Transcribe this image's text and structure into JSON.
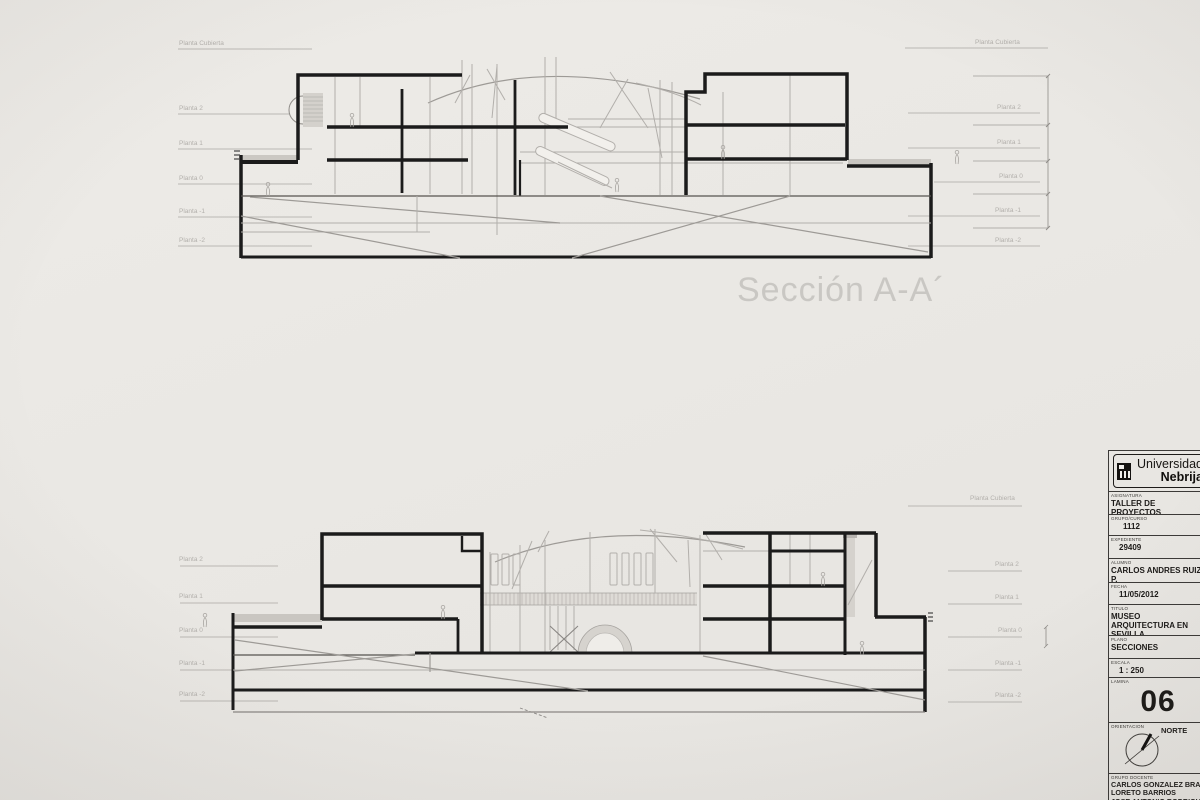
{
  "colors": {
    "paper": "#eae8e4",
    "ink": "#1b1b1b",
    "light_line": "#b2afab",
    "caption": "#c9c7c3"
  },
  "sections": {
    "top": {
      "caption": "Sección A-A´",
      "levels_left": [
        "Planta Cubierta",
        "Planta 2",
        "Planta 1",
        "Planta 0",
        "Planta -1",
        "Planta -2"
      ],
      "levels_right": [
        "Planta Cubierta",
        "Planta 2",
        "Planta 1",
        "Planta 0",
        "Planta -1",
        "Planta -2"
      ]
    },
    "bottom": {
      "levels_left": [
        "Planta 2",
        "Planta 1",
        "Planta 0",
        "Planta -1",
        "Planta -2"
      ],
      "levels_right": [
        "Planta Cubierta",
        "Planta 2",
        "Planta 1",
        "Planta 0",
        "Planta -1",
        "Planta -2"
      ]
    }
  },
  "titleblock": {
    "logo": {
      "name_top": "Universidad",
      "name_bottom": "Nebrija"
    },
    "asignatura": {
      "label": "ASIGNATURA",
      "value": "TALLER DE PROYECTOS"
    },
    "grupo_curso": {
      "label": "GRUPO/CURSO",
      "value": "1112"
    },
    "expediente": {
      "label": "EXPEDIENTE",
      "value": "29409"
    },
    "alumno": {
      "label": "ALUMNO",
      "value": "CARLOS ANDRES RUIZ  P."
    },
    "fecha": {
      "label": "FECHA",
      "value": "11/05/2012"
    },
    "titulo": {
      "label": "TITULO",
      "value": "MUSEO ARQUITECTURA EN  SEVILLA"
    },
    "plano": {
      "label": "PLANO",
      "value": "SECCIONES"
    },
    "escala": {
      "label": "ESCALA",
      "value": "1 : 250"
    },
    "lamina": {
      "label": "LAMINA",
      "value": "06"
    },
    "orientacion": {
      "label": "ORIENTACION",
      "value": "NORTE"
    },
    "grupo_docente": {
      "label": "GRUPO DOCENTE",
      "names": [
        "CARLOS GONZALEZ BRAVO",
        "LORETO BARRIOS",
        "JOSE ANTONIO RODRIGUEZ"
      ]
    }
  }
}
